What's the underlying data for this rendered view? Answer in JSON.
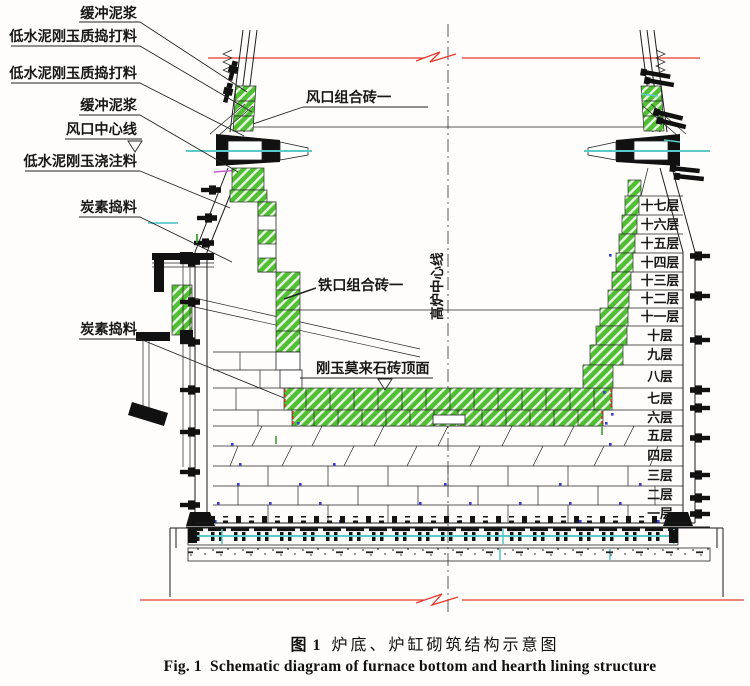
{
  "figure": {
    "caption_zh_fig": "图 1",
    "caption_zh_title": "炉底、炉缸砌筑结构示意图",
    "caption_en_fig": "Fig. 1",
    "caption_en_title": "Schematic diagram of furnace bottom and hearth lining structure"
  },
  "diagram": {
    "centerline_label": "高炉中心线",
    "left_labels": [
      "缓冲泥浆",
      "低水泥刚玉质捣打料",
      "低水泥刚玉质捣打料",
      "缓冲泥浆",
      "风口中心线",
      "低水泥刚玉浇注料",
      "炭素捣料",
      "炭素捣料"
    ],
    "part_labels": {
      "tuyere_brick": "风口组合砖一",
      "taphole_brick": "铁口组合砖一",
      "pad_top": "刚玉莫来石砖顶面"
    },
    "layer_labels": [
      "十七层",
      "十六层",
      "十五层",
      "十四层",
      "十三层",
      "十二层",
      "十一层",
      "十层",
      "九层",
      "八层",
      "七层",
      "六层",
      "五层",
      "四层",
      "三层",
      "二层",
      "一层"
    ],
    "colors": {
      "brick_green": "#51bf33",
      "break_red": "#e6392e",
      "pipe_cyan": "#5cc9c9",
      "joint_blue": "#3b3be0"
    }
  }
}
